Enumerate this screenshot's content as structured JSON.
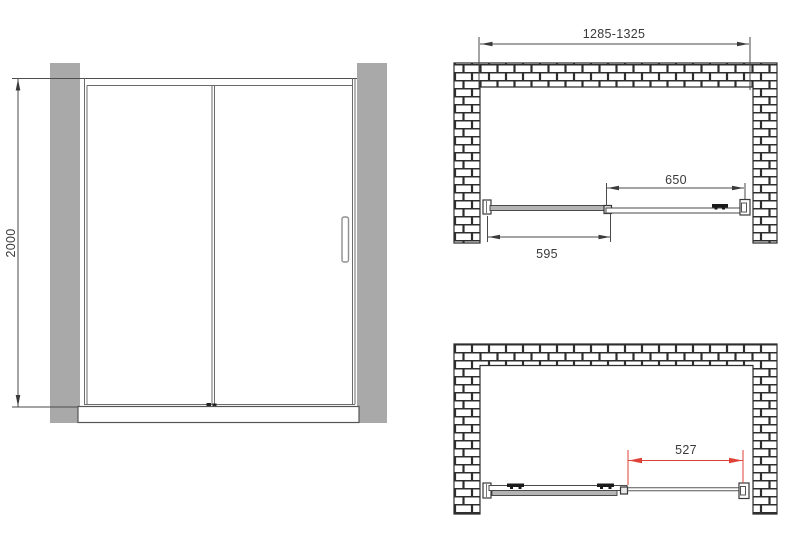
{
  "front_view": {
    "height_dim": "2000"
  },
  "plan_closed": {
    "overall_width_dim": "1285-1325",
    "sliding_panel_dim": "650",
    "fixed_panel_dim": "595"
  },
  "plan_open": {
    "opening_dim": "527"
  },
  "colors": {
    "line": "#4a4a4a",
    "dim_text": "#3a3a3a",
    "accent_red": "#de4237",
    "wall_gray": "#a9a9a9",
    "panel_gray": "#b4b4b4",
    "mortar": "#2e2e2e"
  }
}
